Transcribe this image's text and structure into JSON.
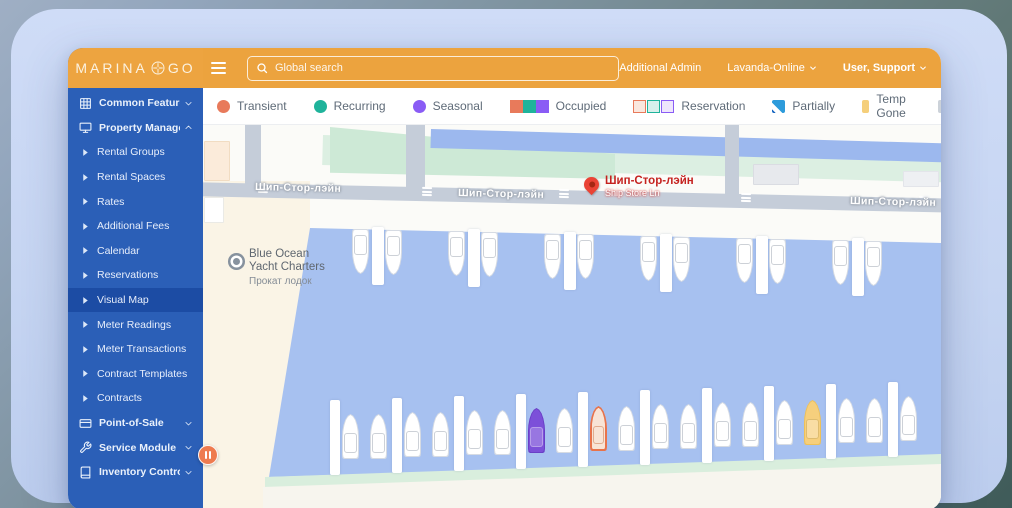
{
  "app": {
    "brand_left": "MARINA",
    "brand_right": "GO"
  },
  "topbar": {
    "search_placeholder": "Global search",
    "links": [
      {
        "label": "Additional Admin",
        "caret": false,
        "bold": false
      },
      {
        "label": "Lavanda-Online",
        "caret": true,
        "bold": false
      },
      {
        "label": "User, Support",
        "caret": true,
        "bold": true
      }
    ]
  },
  "sidebar": {
    "items": [
      {
        "label": "Common Features",
        "icon": "grid-icon",
        "type": "group",
        "chevron": "down"
      },
      {
        "label": "Property Management",
        "icon": "monitor-icon",
        "type": "group",
        "chevron": "up"
      },
      {
        "label": "Rental Groups",
        "type": "sub"
      },
      {
        "label": "Rental Spaces",
        "type": "sub"
      },
      {
        "label": "Rates",
        "type": "sub"
      },
      {
        "label": "Additional Fees",
        "type": "sub"
      },
      {
        "label": "Calendar",
        "type": "sub"
      },
      {
        "label": "Reservations",
        "type": "sub"
      },
      {
        "label": "Visual Map",
        "type": "sub",
        "active": true
      },
      {
        "label": "Meter Readings",
        "type": "sub"
      },
      {
        "label": "Meter Transactions",
        "type": "sub"
      },
      {
        "label": "Contract Templates",
        "type": "sub"
      },
      {
        "label": "Contracts",
        "type": "sub"
      },
      {
        "label": "Point-of-Sale",
        "icon": "card-icon",
        "type": "group",
        "chevron": "down"
      },
      {
        "label": "Service Module",
        "icon": "wrench-icon",
        "type": "group",
        "chevron": "down"
      },
      {
        "label": "Inventory Control",
        "icon": "book-icon",
        "type": "group",
        "chevron": "down"
      }
    ]
  },
  "legend": {
    "items": [
      {
        "label": "Transient",
        "swatch": "circle",
        "colors": [
          "#e87a5b"
        ]
      },
      {
        "label": "Recurring",
        "swatch": "circle",
        "colors": [
          "#1fb39b"
        ]
      },
      {
        "label": "Seasonal",
        "swatch": "circle",
        "colors": [
          "#8a5cf5"
        ]
      },
      {
        "label": "Occupied",
        "swatch": "triple-solid",
        "colors": [
          "#e87a5b",
          "#1fb39b",
          "#8a5cf5"
        ]
      },
      {
        "label": "Reservation",
        "swatch": "triple-light",
        "colors": [
          "#e87a5b",
          "#1fb39b",
          "#8a5cf5"
        ],
        "fills": [
          "#fae7de",
          "#d8f0ec",
          "#eee6fc"
        ]
      },
      {
        "label": "Partially",
        "swatch": "partial",
        "colors": [
          "#2d9bdb"
        ]
      },
      {
        "label": "Temp Gone",
        "swatch": "square",
        "colors": [
          "#f5cf7b"
        ]
      },
      {
        "label": "Vacant",
        "swatch": "square",
        "colors": [
          "#ccd2d9"
        ]
      }
    ]
  },
  "map": {
    "street_labels": [
      {
        "text": "Шип-Стор-лэйн",
        "x": 52,
        "y": 57
      },
      {
        "text": "Шип-Стор-лэйн",
        "x": 255,
        "y": 63
      },
      {
        "text": "Шип-Стор-лэйн",
        "x": 647,
        "y": 71
      }
    ],
    "marker": {
      "title": "Шип-Стор-лэйн",
      "subtitle": "Ship Store Ln",
      "x": 381,
      "y": 52
    },
    "poi": {
      "line1": "Blue Ocean",
      "line2": "Yacht Charters",
      "line3": "Прокат лодок",
      "x": 46,
      "y": 123,
      "dot_x": 30,
      "dot_y": 133
    },
    "water_color": "#a7c1f0",
    "docks_top": [
      {
        "x": 169,
        "y": 102
      },
      {
        "x": 265,
        "y": 104
      },
      {
        "x": 361,
        "y": 107
      },
      {
        "x": 457,
        "y": 109
      },
      {
        "x": 553,
        "y": 111
      },
      {
        "x": 649,
        "y": 113
      }
    ],
    "boats_top": [
      {
        "x": 149,
        "y": 104
      },
      {
        "x": 182,
        "y": 105
      },
      {
        "x": 245,
        "y": 106
      },
      {
        "x": 278,
        "y": 107
      },
      {
        "x": 341,
        "y": 109
      },
      {
        "x": 374,
        "y": 109
      },
      {
        "x": 437,
        "y": 111
      },
      {
        "x": 470,
        "y": 112
      },
      {
        "x": 533,
        "y": 113
      },
      {
        "x": 566,
        "y": 114
      },
      {
        "x": 629,
        "y": 115
      },
      {
        "x": 662,
        "y": 116
      }
    ],
    "docks_bottom": [
      {
        "x": 127,
        "y": 275
      },
      {
        "x": 189,
        "y": 273
      },
      {
        "x": 251,
        "y": 271
      },
      {
        "x": 313,
        "y": 269
      },
      {
        "x": 375,
        "y": 267
      },
      {
        "x": 437,
        "y": 265
      },
      {
        "x": 499,
        "y": 263
      },
      {
        "x": 561,
        "y": 261
      },
      {
        "x": 623,
        "y": 259
      },
      {
        "x": 685,
        "y": 257
      }
    ],
    "boats_bottom": [
      {
        "x": 139,
        "y": 289,
        "variant": "white"
      },
      {
        "x": 167,
        "y": 289,
        "variant": "white"
      },
      {
        "x": 201,
        "y": 287,
        "variant": "white"
      },
      {
        "x": 229,
        "y": 287,
        "variant": "white"
      },
      {
        "x": 263,
        "y": 285,
        "variant": "white"
      },
      {
        "x": 291,
        "y": 285,
        "variant": "white"
      },
      {
        "x": 325,
        "y": 283,
        "variant": "seasonal"
      },
      {
        "x": 353,
        "y": 283,
        "variant": "white"
      },
      {
        "x": 387,
        "y": 281,
        "variant": "reservation"
      },
      {
        "x": 415,
        "y": 281,
        "variant": "white"
      },
      {
        "x": 449,
        "y": 279,
        "variant": "white"
      },
      {
        "x": 477,
        "y": 279,
        "variant": "white"
      },
      {
        "x": 511,
        "y": 277,
        "variant": "white"
      },
      {
        "x": 539,
        "y": 277,
        "variant": "white"
      },
      {
        "x": 573,
        "y": 275,
        "variant": "white"
      },
      {
        "x": 601,
        "y": 275,
        "variant": "temp-gone"
      },
      {
        "x": 635,
        "y": 273,
        "variant": "white"
      },
      {
        "x": 663,
        "y": 273,
        "variant": "white"
      },
      {
        "x": 697,
        "y": 271,
        "variant": "white"
      }
    ]
  }
}
